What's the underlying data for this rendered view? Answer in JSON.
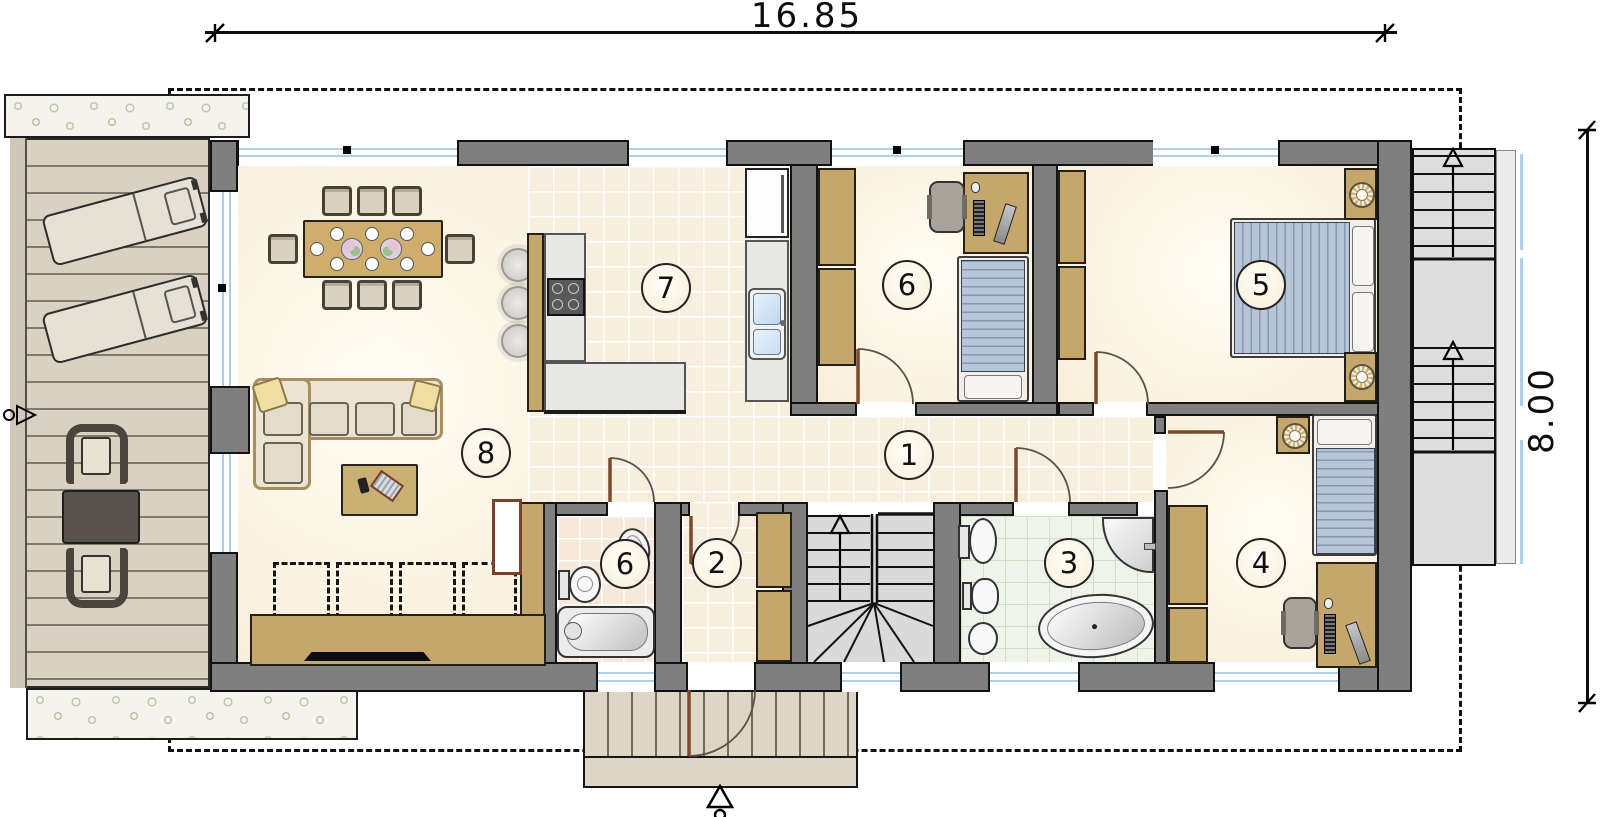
{
  "annotations": {
    "width_label": "16.85",
    "height_label": "8.00"
  },
  "rooms": {
    "hallway": {
      "label": "1"
    },
    "entry_hall": {
      "label": "2"
    },
    "bathroom": {
      "label": "3"
    },
    "bedroom_right": {
      "label": "4"
    },
    "bedroom_master": {
      "label": "5"
    },
    "office_bedroom": {
      "label": "6"
    },
    "wc": {
      "label": "6"
    },
    "kitchen": {
      "label": "7"
    },
    "living_room": {
      "label": "8"
    }
  },
  "icons": {
    "stairs_up_arrow": "hollow-up-arrow",
    "entry_arrow": "hollow-up-arrow-with-circle",
    "section_marker": "circle-triangle"
  },
  "colors": {
    "wall": "#7f7f7f",
    "window_glass": "#aecfe8",
    "wood": "#c6a76b",
    "bed_fabric": "#b7c5d8",
    "deck": "#d9d2c3",
    "bath_tile": "#eef4ea",
    "wc_tile": "#f7e9da",
    "hall_tile": "#f8eedd",
    "room_floor": "#fbf3e1",
    "greenery": "#a3b58e",
    "door_leaf": "#7b4a2d"
  }
}
